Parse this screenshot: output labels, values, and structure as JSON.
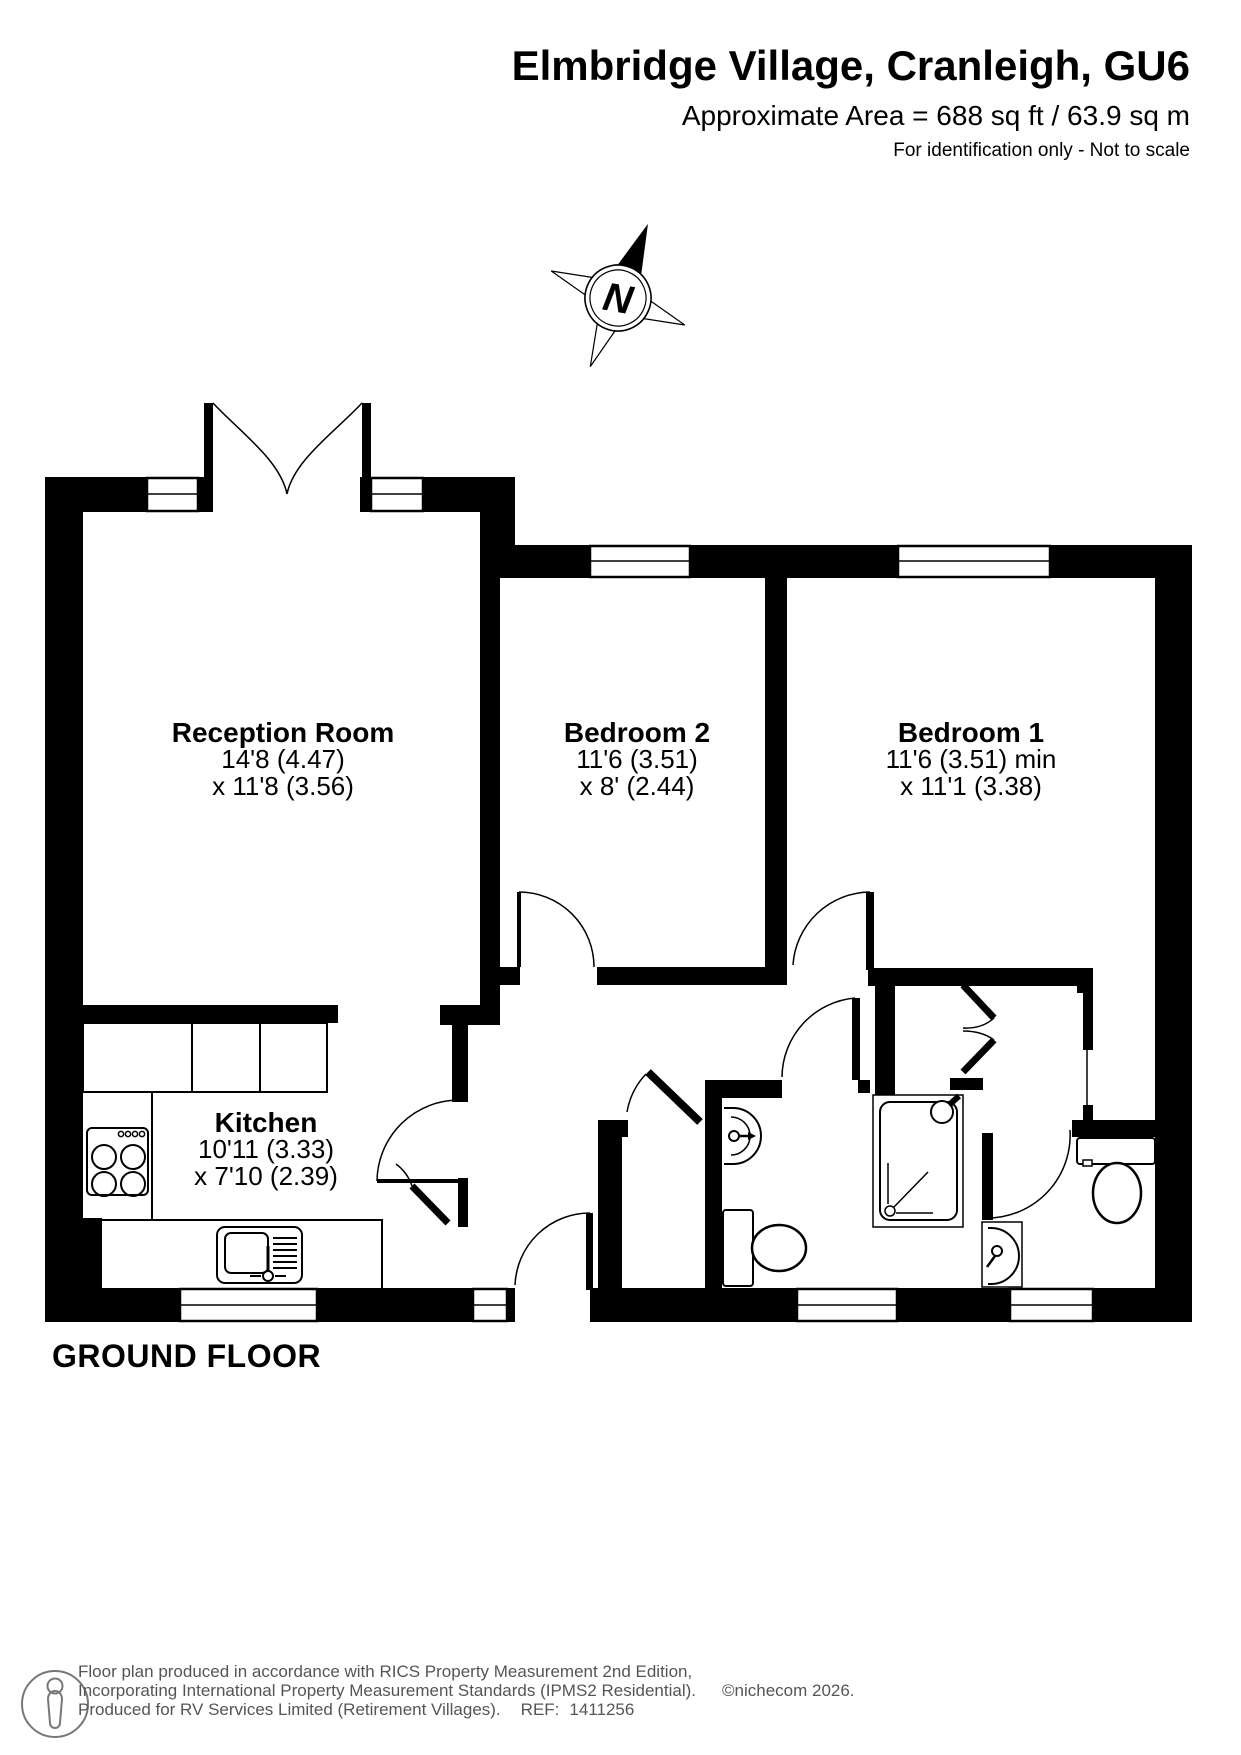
{
  "header": {
    "title": "Elmbridge Village, Cranleigh, GU6",
    "area": "Approximate Area = 688 sq ft / 63.9 sq m",
    "note": "For identification only - Not to scale"
  },
  "compass": {
    "label": "N"
  },
  "floor_label": "GROUND FLOOR",
  "rooms": [
    {
      "name": "Reception Room",
      "dim1": "14'8 (4.47)",
      "dim2": "x 11'8 (3.56)"
    },
    {
      "name": "Bedroom 2",
      "dim1": "11'6 (3.51)",
      "dim2": "x 8' (2.44)"
    },
    {
      "name": "Bedroom 1",
      "dim1": "11'6 (3.51) min",
      "dim2": "x 11'1 (3.38)"
    },
    {
      "name": "Kitchen",
      "dim1": "10'11 (3.33)",
      "dim2": "x 7'10 (2.39)"
    }
  ],
  "footer": {
    "line1": "Floor plan produced in accordance with RICS Property Measurement 2nd Edition,",
    "line2": "Incorporating International Property Measurement Standards (IPMS2 Residential).",
    "copyright": "©nichecom 2026.",
    "line3": "Produced for RV Services Limited (Retirement Villages).",
    "ref_label": "REF:",
    "ref_value": "1411256"
  },
  "colors": {
    "wall": "#000000",
    "footer_text": "#555555"
  }
}
